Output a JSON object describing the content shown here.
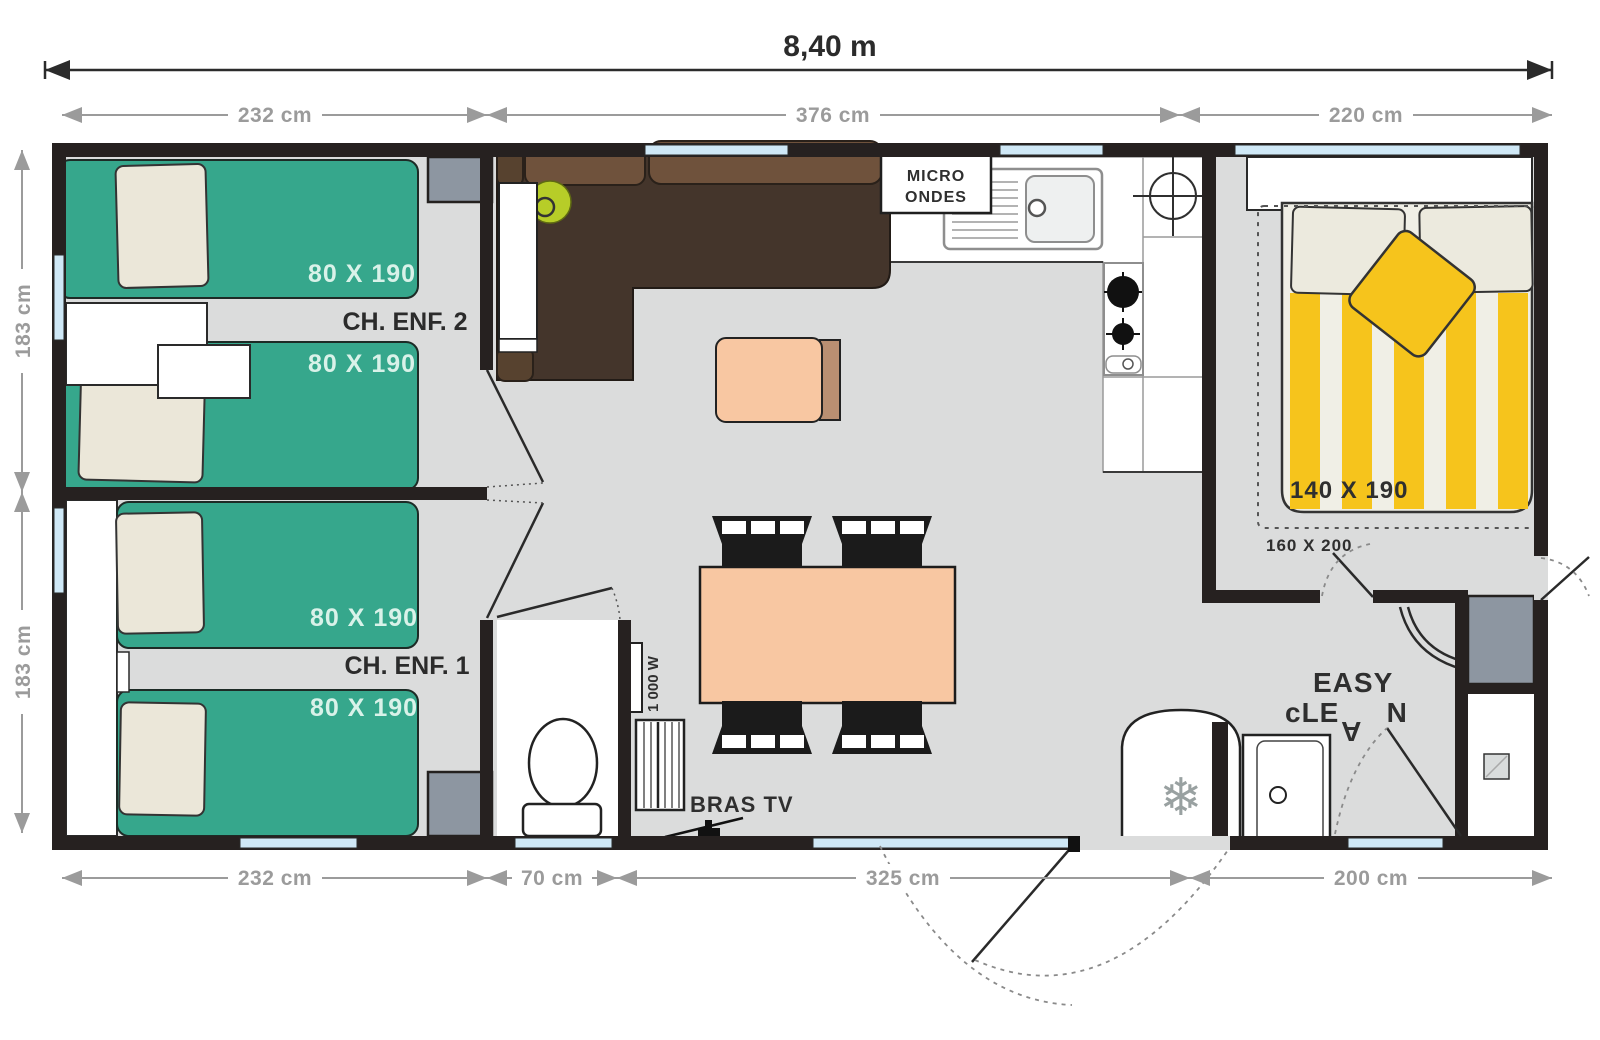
{
  "plan": {
    "overall_width": "8,40 m",
    "dims_top": [
      "232 cm",
      "376 cm",
      "220 cm"
    ],
    "dims_left": [
      "183 cm",
      "183 cm"
    ],
    "dims_bottom": [
      "232 cm",
      "70 cm",
      "325 cm",
      "200 cm"
    ],
    "rooms": {
      "child2": "CH. ENF. 2",
      "child1": "CH. ENF. 1"
    },
    "beds": {
      "single": "80 X 190",
      "double": "140 X 190",
      "zone": "160 X 200"
    },
    "kitchen": {
      "micro_line1": "MICRO",
      "micro_line2": "ONDES"
    },
    "labels": {
      "tv": "BRAS TV",
      "heater": "1 000 W",
      "snowflake": "❄"
    },
    "logo": {
      "line1": "EASY",
      "line2_a": "cLE",
      "line2_b": "A",
      "line2_c": "N"
    },
    "colors": {
      "bed_green": "#36a78c",
      "accent_yellow": "#f6c41c",
      "sofa_brown": "#44352b",
      "cushion_brown": "#6f523c",
      "table_peach": "#f8c7a2",
      "wall": "#262120",
      "floor": "#dbdcdc",
      "window_blue": "#cfe8f6",
      "wardrobe_gray": "#8d96a1",
      "dim_gray": "#9b9b9b",
      "lamp_green": "#b7cd28",
      "bed_label_mint": "#d9f2e9"
    }
  }
}
